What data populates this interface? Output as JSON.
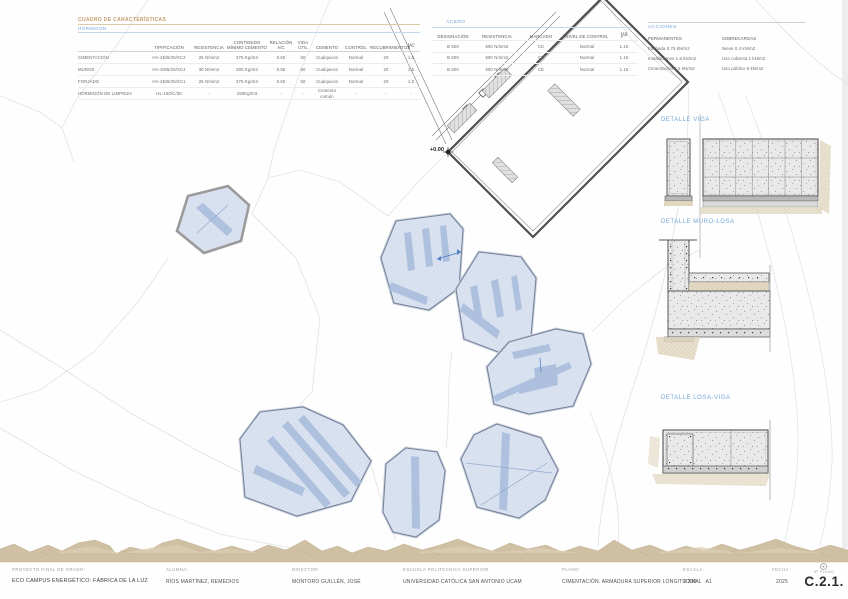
{
  "colors": {
    "accent_blue": "#74A7D8",
    "title_tan": "#C49A6C",
    "slab_fill": "#DBE3F1",
    "slab_band": "#A9BEDD",
    "terrain": "#CFC0A4"
  },
  "tables": {
    "caracteristicas": {
      "title": "CUADRO DE CARACTERÍSTICAS",
      "subtitle": "HORMIGÓN",
      "col_headers": [
        "TIPIFICACIÓN",
        "RESISTENCIA",
        "CONTENIDO MÍNIMO CEMENTO",
        "RELACIÓN A/C",
        "VIDA ÚTIL",
        "CEMENTO",
        "CONTROL",
        "RECUBRIMIENTOS",
        "γc"
      ],
      "rows": [
        {
          "label": "CIMENTACIÓN",
          "c": [
            "HA-25/B/20/XC2",
            "25 N/mm2",
            "275 Kg/m3",
            "0.60",
            "50",
            "Cualquiera",
            "Normal",
            "20",
            "1.5"
          ]
        },
        {
          "label": "MUROS",
          "c": [
            "HA-30/B/20/XC4",
            "30 N/mm2",
            "300 Kg/m3",
            "0.55",
            "50",
            "Cualquiera",
            "Normal",
            "20",
            "1.5"
          ]
        },
        {
          "label": "FORJADO",
          "c": [
            "HA-25/B/20/XC1",
            "25 N/mm2",
            "275 Kg/m3",
            "0.60",
            "50",
            "Cualquiera",
            "Normal",
            "20",
            "1.5"
          ]
        },
        {
          "label": "HORMIGÓN DE LIMPIEZA",
          "c": [
            "HL-150/C/30",
            "-",
            "150Kg/m3",
            "-",
            "-",
            "Cemento común",
            "-",
            "-",
            "-"
          ]
        }
      ]
    },
    "acero": {
      "title": "ACERO",
      "col_headers": [
        "DESIGNACIÓN",
        "RESISTENCIA",
        "MARCADO",
        "NIVEL DE CONTROL",
        "γs"
      ],
      "rows": [
        {
          "c": [
            "B 500",
            "500 N/mm2",
            "CE",
            "Normal",
            "1.15"
          ]
        },
        {
          "c": [
            "B 500",
            "500 N/mm2",
            "CE",
            "Normal",
            "1.15"
          ]
        },
        {
          "c": [
            "B 500",
            "500 N/mm2",
            "CE",
            "Normal",
            "1.15"
          ]
        }
      ]
    },
    "acciones": {
      "title": "ACCIONES",
      "permanentes_header": "PERMANENTES",
      "sobrecargas_header": "SOBRECARGAS",
      "permanentes": [
        "Fachada 0.75 kN/m2",
        "Instalaciones 1.6 kN/m2",
        "Cimentación 1.5 kN/m2"
      ],
      "sobrecargas": [
        "Nieve 0.4 kN/m2",
        "Uso cubierta 1 kN/m2",
        "Uso público 5 kN/m2"
      ]
    }
  },
  "details": {
    "viga_label": "DETALLE VIGA",
    "muro_losa_label": "DETALLE MURO-LOSA",
    "losa_viga_label": "DETALLE LOSA-VIGA"
  },
  "plan": {
    "level_mark": "+0.00"
  },
  "titleblock": {
    "project_label": "PROYECTO FINAL DE GRADO:",
    "project_value": "ECO CAMPUS ENERGÉTICO: FÁBRICA DE LA LUZ",
    "student_label": "ALUMNA:",
    "student_value": "RÍOS MARTÍNEZ, REMEDIOS",
    "director_label": "DIRECTOR:",
    "director_value": "MONTORO GUILLÉN, JOSÉ",
    "school_label": "ESCUELA POLITÉCNICA SUPERIOR",
    "school_value": "UNIVERSIDAD CATÓLICA SAN ANTONIO UCAM",
    "sheet_label": "PLANO:",
    "sheet_value": "CIMENTACIÓN. ARMADURA SUPERIOR LONGITUDINAL",
    "scale_label": "ESCALA:",
    "scale_value": "1:200",
    "format_value": "A1",
    "date_label": "FECHA:",
    "date_value": "2025",
    "number_label": "Nº PLANO",
    "number_value": "C.2.1."
  }
}
